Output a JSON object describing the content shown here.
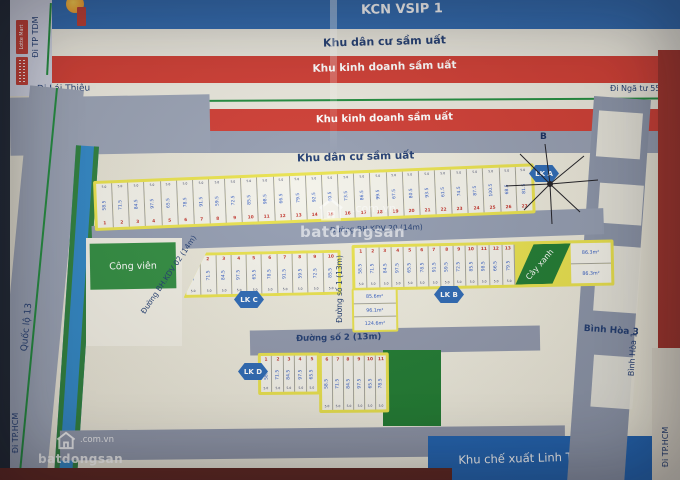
{
  "title_bands": {
    "kcn": "KCN VSIP 1",
    "residential_top": "Khu dân cư sầm uất",
    "business_1": "Khu kinh doanh sầm uất",
    "dt743c": "ĐT 743C",
    "business_2": "Khu kinh doanh sầm uất",
    "residential_mid": "Khu dân cư sầm uất"
  },
  "directions": {
    "tdm": "Đi TP TDM",
    "lai_thieu": "Đi Lái Thiêu",
    "nga_tu_550": "Đi Ngã tư 550",
    "hcm_left": "Đi TP.HCM",
    "hcm_right": "Đi TP.HCM"
  },
  "landmarks": {
    "lotte": "Lotte Mart"
  },
  "streets": {
    "ql13": "Quốc lộ 13",
    "bh_kdv_20": "Đường BH.KDV 20 (14m)",
    "bh_kdv_02": "Đường BH.KDV 02 (14m)",
    "so_1": "Đường số 1 (13m)",
    "so_2": "Đường số 2 (13m)",
    "binh_hoa_1": "Bình Hòa 1",
    "binh_hoa_3": "Bình Hòa 3"
  },
  "areas": {
    "cong_vien": "Công viên",
    "cay_xanh": "Cây xanh",
    "linh_trung": "Khu chế xuất Linh Trung"
  },
  "blocks": [
    {
      "name": "LK A",
      "plot_count": 27
    },
    {
      "name": "LK C",
      "plot_count": 10
    },
    {
      "name": "LK B",
      "plot_count": 13
    },
    {
      "name": "LK D",
      "plot_count": 11
    }
  ],
  "plot_labels": {
    "edge_dim": "5.0",
    "corner_areas": [
      "85.6m²",
      "96.1m²",
      "124.6m²"
    ],
    "right_areas": [
      "86.3m²",
      "86.3m²"
    ]
  },
  "compass": {
    "north": "B"
  },
  "watermark": {
    "name": "batdongsan",
    "domain": ".com.vn"
  }
}
